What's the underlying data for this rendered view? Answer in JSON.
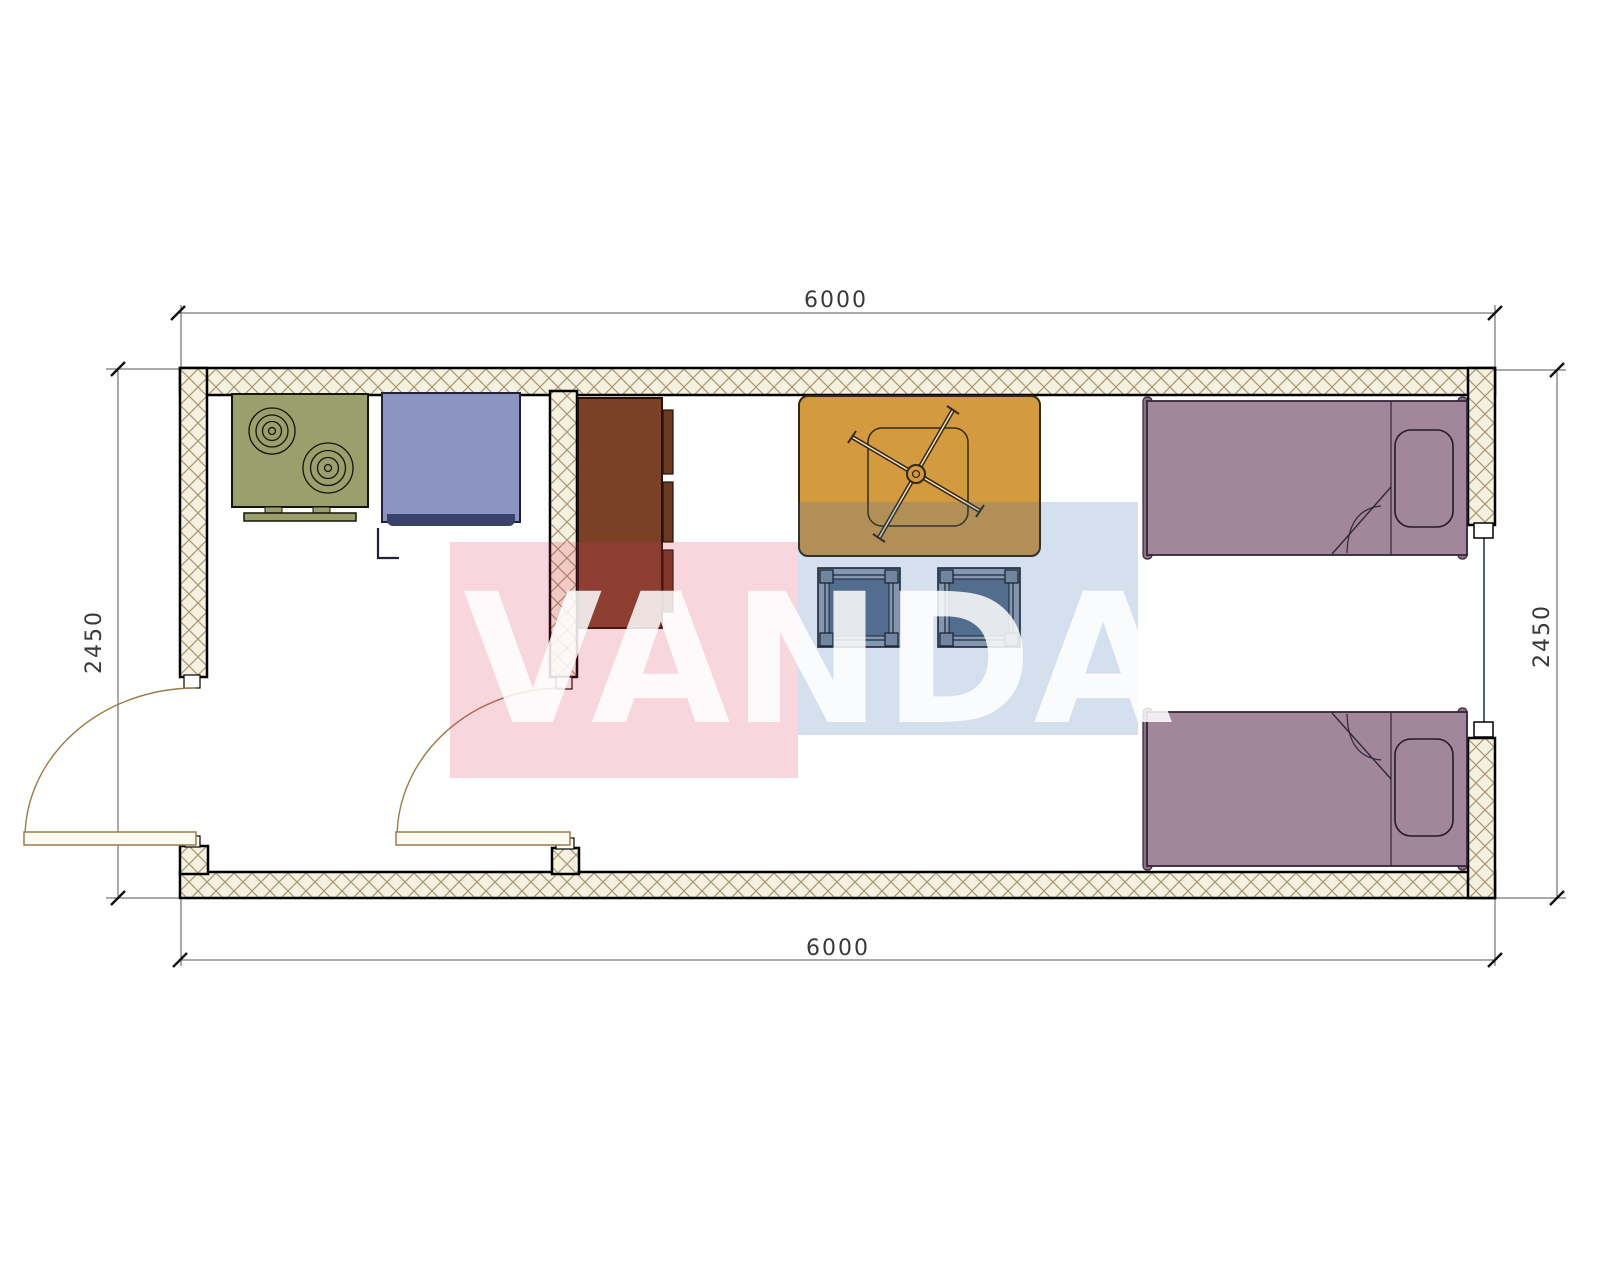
{
  "drawing": {
    "type": "floor-plan",
    "watermark_text": "VANDA",
    "dimensions": {
      "top": "6000",
      "bottom": "6000",
      "left": "2450",
      "right": "2450"
    },
    "rooms": [
      "kitchen-entry-room",
      "living-bedroom"
    ],
    "furniture": [
      {
        "name": "stove",
        "color": "#9aa06c"
      },
      {
        "name": "washing-machine",
        "color": "#8c95c2"
      },
      {
        "name": "wardrobe",
        "color": "#7a4127"
      },
      {
        "name": "table-with-ceiling-fan",
        "color": "#d49a40"
      },
      {
        "name": "stool-left",
        "color": "#5d7086"
      },
      {
        "name": "stool-right",
        "color": "#5d7086"
      },
      {
        "name": "bed-top",
        "color": "#a2879a"
      },
      {
        "name": "bed-bottom",
        "color": "#a2879a"
      }
    ],
    "openings": [
      "entry-door-left-wall",
      "interior-door-partition",
      "window-right-wall"
    ],
    "colors": {
      "wall_outline": "#000000",
      "wall_hatch_line": "#a5946c",
      "wall_hatch_bg": "#f6f0e0",
      "dimension_line": "#555555",
      "dimension_text": "#3a3a3a",
      "door_swing": "#9c7b4a",
      "watermark_red": "#dd3355",
      "watermark_blue": "#2d64af",
      "watermark_letters": "#ffffff"
    }
  }
}
